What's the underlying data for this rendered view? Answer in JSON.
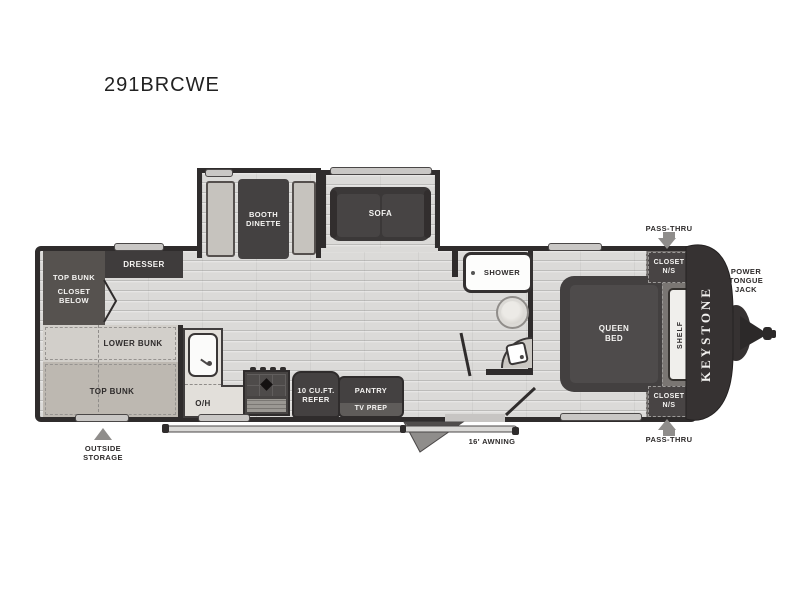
{
  "title": "291BRCWE",
  "brand": "KEYSTONE",
  "colors": {
    "wall": "#2f2c2c",
    "floor": "#dbdad8",
    "dark_furniture": "#444141",
    "light_furniture": "#c9c6c1",
    "arrow_gray": "#8f8d8b",
    "shower_white": "#fdfdfc"
  },
  "exterior": {
    "pass_thru_top": "PASS-THRU",
    "pass_thru_bottom": "PASS-THRU",
    "power_tongue_jack": "POWER\nTONGUE\nJACK",
    "outside_storage": "OUTSIDE\nSTORAGE",
    "awning": "16' AWNING"
  },
  "rooms": {
    "bunkhouse": {
      "dresser": "DRESSER",
      "top_bunk_over_closet": "TOP BUNK",
      "closet_below": "CLOSET\nBELOW",
      "lower_bunk": "LOWER BUNK",
      "top_bunk": "TOP BUNK"
    },
    "living": {
      "booth_dinette": "BOOTH\nDINETTE",
      "sofa": "SOFA"
    },
    "kitchen": {
      "overhead": "O/H",
      "refer": "10 CU.FT.\nREFER",
      "pantry": "PANTRY",
      "tv_prep": "TV PREP"
    },
    "bath": {
      "shower": "SHOWER"
    },
    "bedroom": {
      "queen_bed": "QUEEN\nBED",
      "shelf": "SHELF",
      "closet_ns_top": "CLOSET\nN/S",
      "closet_ns_bottom": "CLOSET\nN/S"
    }
  }
}
